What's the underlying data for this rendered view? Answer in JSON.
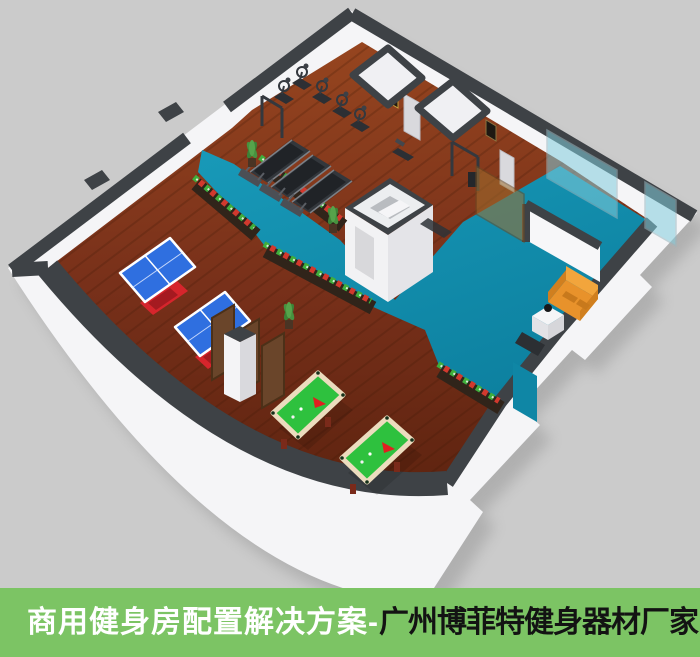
{
  "banner": {
    "background": "#7cc464",
    "text_primary": "商用健身房配置解决方案-",
    "text_secondary": "广州博菲特健身器材厂家",
    "text_primary_color": "#ffffff",
    "text_secondary_color": "#131313"
  },
  "colors": {
    "page_background": "#cbcbcb",
    "wall_white": "#f5f5f7",
    "wall_shadow": "#e2e2e6",
    "wall_top_dark": "#3e4246",
    "floor_wood_light": "#96451f",
    "floor_wood_dark": "#5f2410",
    "floor_teal": "#1595b5",
    "floor_teal_dark": "#0d81a0",
    "ping_pong_blue": "#2f6fe0",
    "ping_pong_base_red": "#d6252c",
    "billiard_green": "#2ec13e",
    "billiard_rail": "#ecdcbe",
    "billiard_triangle_red": "#e02020",
    "sofa_orange": "#e8932c",
    "planter_box_brown": "#30241a",
    "flower_red": "#d2392e",
    "flower_green": "#3fae3c",
    "equipment_dark": "#33373c",
    "glass_teal": "#82cddc",
    "glass_bronze": "#a06e2d"
  },
  "scene": {
    "type": "3d-isometric-floor-plan",
    "rooms": [
      "table-tennis-area",
      "gym-equipment-area",
      "billiards-area",
      "teal-walkway-and-lounge",
      "changing-rooms",
      "storage-room"
    ],
    "furniture_counts": {
      "ping_pong_tables": 2,
      "billiard_tables": 2,
      "treadmills": 3,
      "cardio_machines": 5,
      "strength_stations": 3,
      "planter_boxes": 4,
      "partition_screens": 3,
      "sofas": 1,
      "potted_plants": 3,
      "glass_partitions": 3
    }
  }
}
